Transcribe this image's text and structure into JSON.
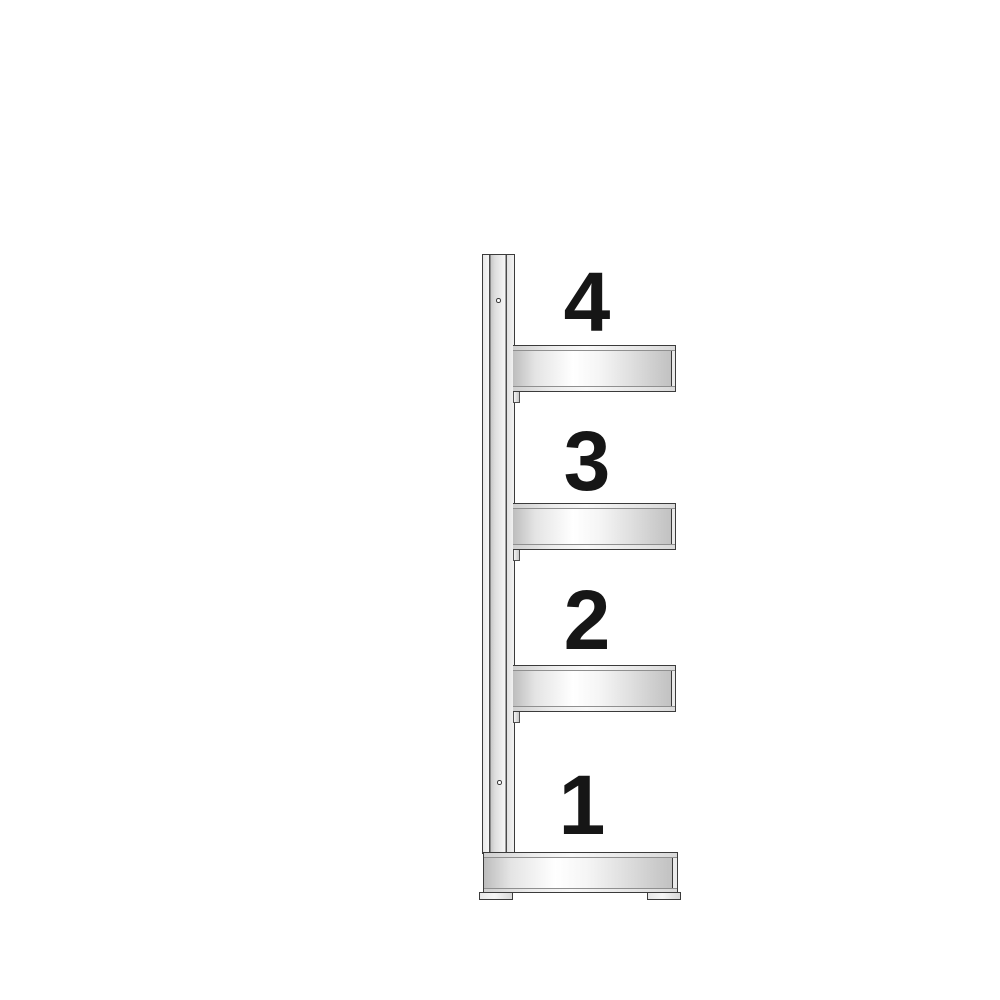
{
  "figure": {
    "type": "shelving-unit-side-profile-diagram",
    "colors": {
      "background": "#ffffff",
      "outline": "#3b3b3b",
      "inner-line": "#8f8f8f",
      "metal-bright": "#ffffff",
      "metal-shadow": "#c2c2c2",
      "label-ink": "#161616"
    }
  },
  "shelving_unit": {
    "levels": [
      {
        "label": "4",
        "support": "cantilever-shelf-arm"
      },
      {
        "label": "3",
        "support": "cantilever-shelf-arm"
      },
      {
        "label": "2",
        "support": "cantilever-shelf-arm"
      },
      {
        "label": "1",
        "support": "base-shelf"
      }
    ],
    "post_hole_count": 2,
    "feet_count": 2
  }
}
